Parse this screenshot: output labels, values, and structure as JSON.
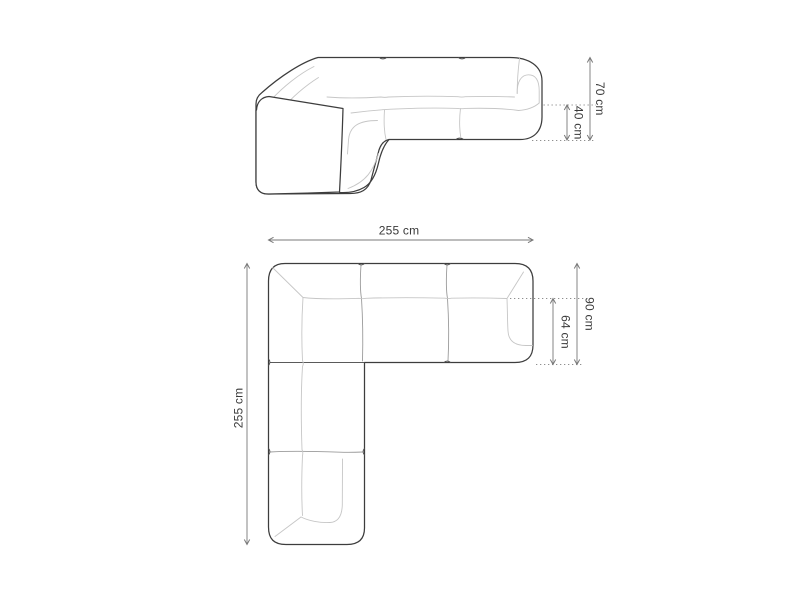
{
  "diagram": {
    "title": "corner-sofa-dimension-diagram",
    "background": "#ffffff",
    "colors": {
      "outline": "#3d3d3d",
      "seam": "#c6c6c6",
      "divider": "#9b9b9b",
      "dimension_line": "#787878",
      "dotted_line": "#8f8f8f",
      "label_text": "#3a3a3a"
    },
    "views": {
      "front": {
        "name": "front-elevation-view",
        "dims": {
          "total_height": "70 cm",
          "seat_height": "40 cm"
        }
      },
      "top": {
        "name": "top-plan-view",
        "dims": {
          "width": "255 cm",
          "depth": "255 cm",
          "arm_depth": "90 cm",
          "seat_depth": "64 cm"
        }
      }
    }
  }
}
